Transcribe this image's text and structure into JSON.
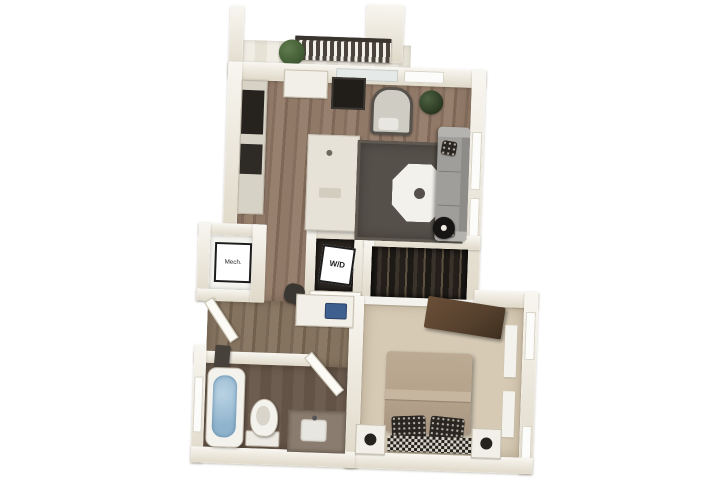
{
  "meta": {
    "description": "3D rendered top-down floor plan of a one-bedroom, one-bathroom apartment with balcony",
    "background": "#ffffff"
  },
  "labels": {
    "mech_closet": "Mech.",
    "washer_dryer": "W/D"
  },
  "colors": {
    "wall_hi": "#f8f6f0",
    "wall_lo": "#e0d9c9",
    "wall_edge": "#bfb6a3",
    "wood": "#8a7262",
    "wood_hall": "#7e6c5a",
    "floor_bath": "#695949",
    "carpet": "#d6cab5",
    "rug": "#56504a",
    "water": "#8fb3cd",
    "plant": "#3c5530",
    "railing": "#4a443c",
    "appliance_dark": "#26231f",
    "island": "#e6e2d7",
    "couch": "#a09e9a",
    "bed": "#b5a28b",
    "dresser": "#55402d",
    "closet_dark": "#29241f",
    "label_ink": "#1c1c1c",
    "window": "#fcfcfa",
    "door_glass": "#e5e9e7"
  },
  "rooms": [
    {
      "name": "balcony",
      "furniture": [
        "railing",
        "potted-plant"
      ]
    },
    {
      "name": "kitchen",
      "furniture": [
        "counter-run",
        "refrigerator",
        "stove",
        "wall-cabinet",
        "wall-tv",
        "kitchen-island"
      ]
    },
    {
      "name": "living-room",
      "furniture": [
        "area-rug",
        "octagonal-coffee-table",
        "sofa",
        "accent-chair",
        "floor-lamp",
        "plant"
      ]
    },
    {
      "name": "mechanical-closet",
      "furniture": [
        "label-card"
      ]
    },
    {
      "name": "laundry-closet",
      "furniture": [
        "washer-dryer",
        "label-card"
      ]
    },
    {
      "name": "hallway",
      "furniture": [
        "entry-door",
        "console-bench",
        "desk",
        "desk-chair",
        "laptop"
      ]
    },
    {
      "name": "bedroom",
      "furniture": [
        "bed",
        "pillows",
        "nightstand-left",
        "nightstand-right",
        "dresser",
        "wardrobe-closet",
        "windows"
      ]
    },
    {
      "name": "bathroom",
      "furniture": [
        "bathtub",
        "toilet",
        "vanity",
        "sink",
        "door"
      ]
    }
  ]
}
